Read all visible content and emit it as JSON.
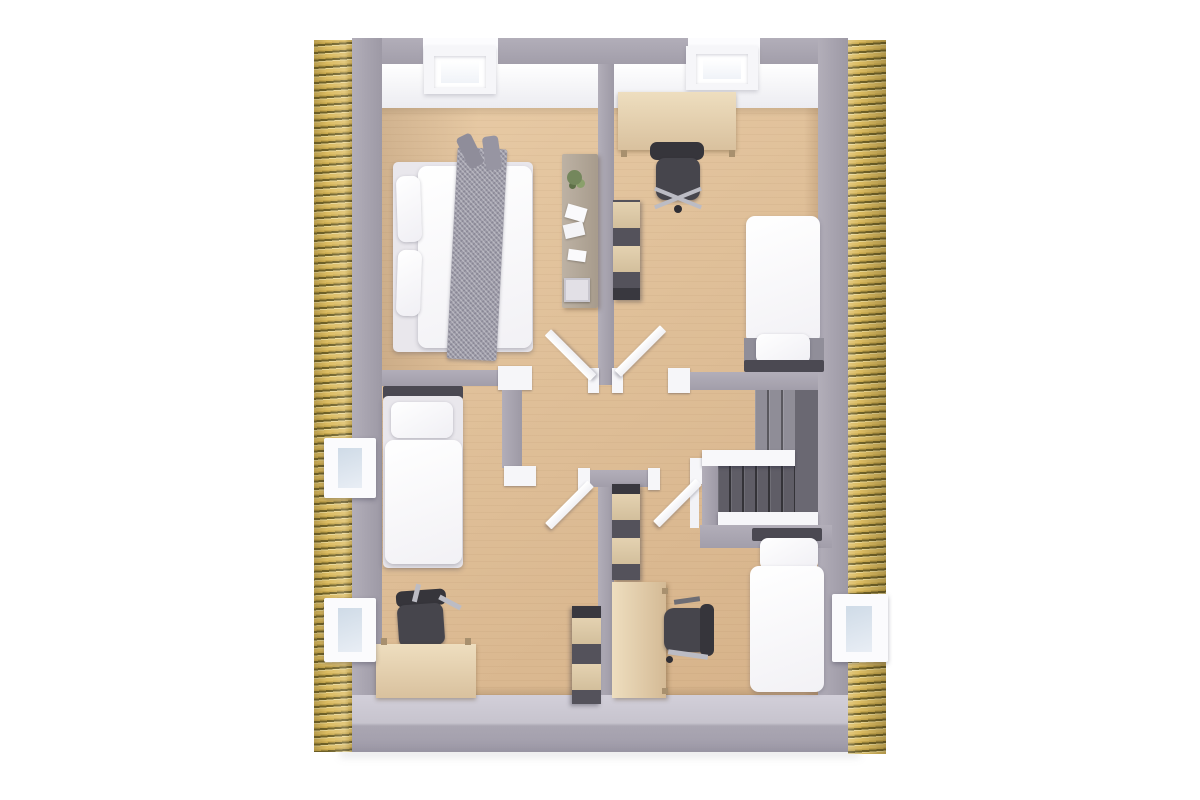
{
  "scene": {
    "kind": "architectural 3d floor plan, top-down dollhouse cutaway of an upper storey",
    "background_color": "#ffffff",
    "text_visible": "none"
  },
  "palette": {
    "roof_thatch_light": "#dcbc62",
    "roof_thatch_dark": "#6f6128",
    "wall_gray": "#a7a3ae",
    "wall_inner_light": "#c9c6d0",
    "ceiling_white": "#f4f4f7",
    "floor_wood": "#dfbf98",
    "stair_steps_dark": "#5f5d66",
    "stair_landing": "#6a6872",
    "bedding_white": "#f8f7fa",
    "throw_blanket_gray": "#9d9ba8",
    "desk_wood": "#e2cda9",
    "office_chair_dark": "#46454c",
    "shelf_frame_dark": "#54525b",
    "shelf_box_wood": "#dcc9a8",
    "window_glass_blue": "#d4dfe9",
    "door_white": "#fdfdfe"
  },
  "building": {
    "roof_bands": [
      "left striped thatch band",
      "right striped thatch band"
    ],
    "skylights": [
      "skylight top-left room",
      "skylight top-right room"
    ],
    "dormer_windows": [
      "left wall upper dormer",
      "left wall lower dormer",
      "right wall lower dormer"
    ],
    "doors_open": 4,
    "staircase": {
      "flights": 2,
      "landing": "right side",
      "banister": "white"
    }
  },
  "rooms": [
    {
      "id": "bedroom-top-left",
      "furniture": [
        "double-bed",
        "two-pillows",
        "gray-throw-runner",
        "console-table",
        "potted-plant",
        "scattered-photos",
        "storage-box"
      ]
    },
    {
      "id": "bedroom-top-right",
      "furniture": [
        "desk",
        "office-chair",
        "wall-shelf-unit",
        "single-bed"
      ]
    },
    {
      "id": "bedroom-bottom-left",
      "furniture": [
        "single-bed",
        "desk",
        "office-chair",
        "wall-shelf-unit"
      ]
    },
    {
      "id": "bedroom-bottom-right",
      "furniture": [
        "single-bed",
        "desk",
        "office-chair",
        "wall-shelf-unit"
      ]
    },
    {
      "id": "hallway",
      "furniture": []
    },
    {
      "id": "stairwell",
      "furniture": [
        "stairs",
        "white-banister"
      ]
    }
  ]
}
